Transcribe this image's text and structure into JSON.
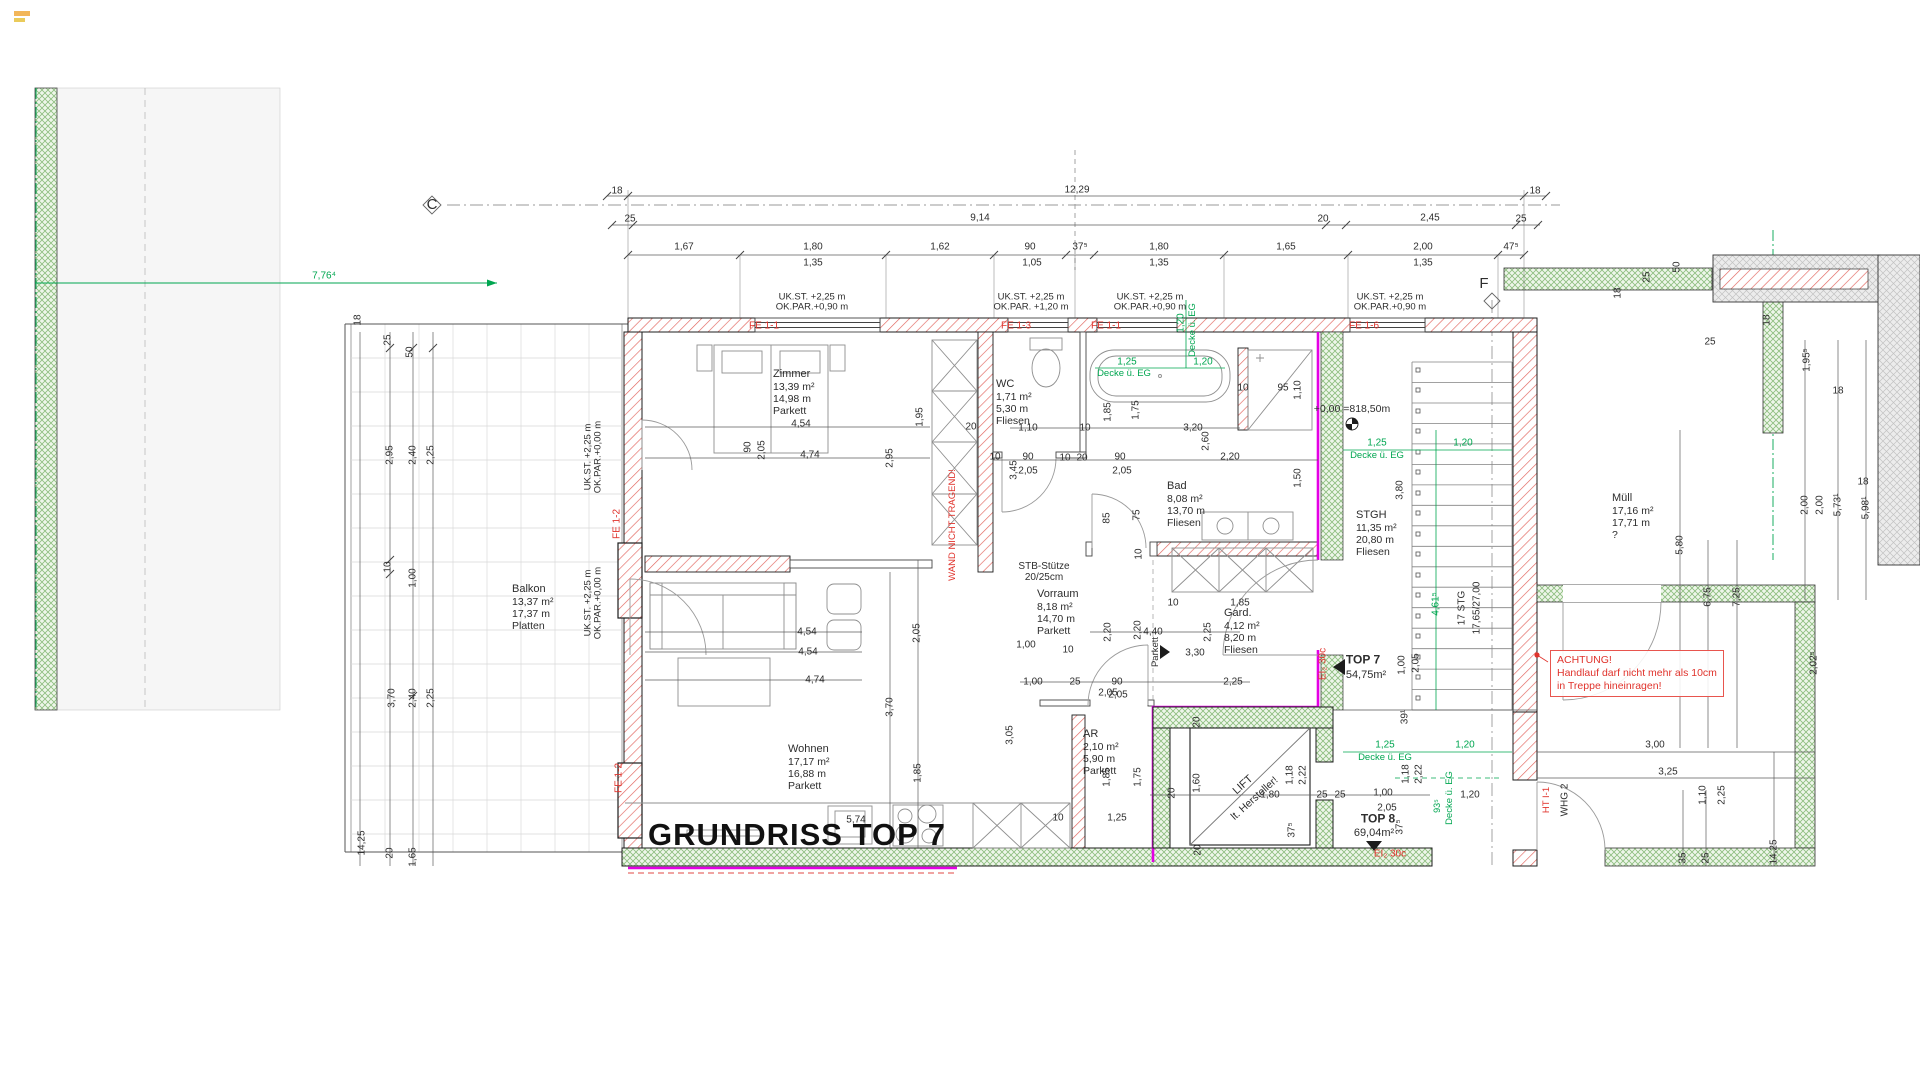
{
  "title": "GRUNDRISS TOP 7",
  "colors": {
    "red": "#e0332c",
    "green": "#00a650",
    "magenta": "#e400e4",
    "dim_text": "#2e2e2e",
    "wall": "#1c1c1c"
  },
  "notes": {
    "achtung": [
      "ACHTUNG!",
      "Handlauf darf nicht mehr als 10cm",
      "in Treppe hineinragen!"
    ]
  },
  "rooms": [
    {
      "name": "Zimmer",
      "area": "13,39 m²",
      "per": "14,98 m",
      "floor": "Parkett",
      "x": 773,
      "y": 368
    },
    {
      "name": "WC",
      "area": "1,71 m²",
      "per": "5,30 m",
      "floor": "Fliesen",
      "x": 996,
      "y": 378
    },
    {
      "name": "Bad",
      "area": "8,08 m²",
      "per": "13,70 m",
      "floor": "Fliesen",
      "x": 1167,
      "y": 480
    },
    {
      "name": "Vorraum",
      "area": "8,18 m²",
      "per": "14,70 m",
      "floor": "Parkett",
      "x": 1037,
      "y": 588
    },
    {
      "name": "Gard.",
      "area": "4,12 m²",
      "per": "8,20 m",
      "floor": "Fliesen",
      "x": 1224,
      "y": 607
    },
    {
      "name": "STGH",
      "area": "11,35 m²",
      "per": "20,80 m",
      "floor": "Fliesen",
      "x": 1356,
      "y": 509
    },
    {
      "name": "Wohnen",
      "area": "17,17 m²",
      "per": "16,88 m",
      "floor": "Parkett",
      "x": 788,
      "y": 743
    },
    {
      "name": "AR",
      "area": "2,10 m²",
      "per": "5,90 m",
      "floor": "Parkett",
      "x": 1083,
      "y": 728
    },
    {
      "name": "Balkon",
      "area": "13,37 m²",
      "per": "17,37 m",
      "floor": "Platten",
      "x": 512,
      "y": 583
    },
    {
      "name": "Müll",
      "area": "17,16 m²",
      "per": "17,71 m",
      "floor": "?",
      "x": 1612,
      "y": 492
    }
  ],
  "labels": [
    [
      "18",
      617,
      191
    ],
    [
      "12,29",
      1077,
      190
    ],
    [
      "18",
      1535,
      191
    ],
    [
      "25",
      630,
      219
    ],
    [
      "9,14",
      980,
      218
    ],
    [
      "20",
      1323,
      219
    ],
    [
      "2,45",
      1430,
      218
    ],
    [
      "25",
      1521,
      219
    ],
    [
      "1,67",
      684,
      247
    ],
    [
      "1,80",
      813,
      247
    ],
    [
      "1,62",
      940,
      247
    ],
    [
      "90",
      1030,
      247
    ],
    [
      "37⁵",
      1080,
      247
    ],
    [
      "1,80",
      1159,
      247
    ],
    [
      "1,65",
      1286,
      247
    ],
    [
      "2,00",
      1423,
      247
    ],
    [
      "47⁵",
      1511,
      247
    ],
    [
      "1,35",
      813,
      263
    ],
    [
      "1,05",
      1032,
      263
    ],
    [
      "1,35",
      1159,
      263
    ],
    [
      "1,35",
      1423,
      263
    ],
    [
      "UK.ST.   +2,25 m\nOK.PAR.+0,90 m",
      812,
      303,
      0,
      "k",
      9.5
    ],
    [
      "UK.ST.   +2,25 m\nOK.PAR. +1,20 m",
      1031,
      303,
      0,
      "k",
      9.5
    ],
    [
      "UK.ST.   +2,25 m\nOK.PAR.+0,90 m",
      1150,
      303,
      0,
      "k",
      9.5
    ],
    [
      "UK.ST.   +2,25 m\nOK.PAR.+0,90 m",
      1390,
      303,
      0,
      "k",
      9.5
    ],
    [
      "UK.ST.  +2,25 m\nOK.PAR.+0,00 m",
      594,
      457,
      -90,
      "k",
      9.5
    ],
    [
      "UK.ST.  +2,25 m\nOK.PAR.+0,00 m",
      594,
      603,
      -90,
      "k",
      9.5
    ],
    [
      "FE 1-1",
      764,
      326,
      0,
      "r"
    ],
    [
      "FE 1-3",
      1016,
      326,
      0,
      "r"
    ],
    [
      "FE 1-1",
      1106,
      326,
      0,
      "r"
    ],
    [
      "FE 1-6",
      1364,
      326,
      0,
      "r"
    ],
    [
      "FE 1-2",
      617,
      524,
      -90,
      "r"
    ],
    [
      "FE 1-2",
      619,
      778,
      -90,
      "r"
    ],
    [
      "WAND NICHT TRAGEND!",
      953,
      525,
      -90,
      "r",
      9.5
    ],
    [
      "EI₂ 30c",
      1323,
      664,
      -90,
      "r"
    ],
    [
      "EI₂ 30c",
      1390,
      854,
      0,
      "r"
    ],
    [
      "HT I-1",
      1547,
      800,
      -90,
      "r",
      9.5
    ],
    [
      "7,76⁴",
      324,
      276,
      0,
      "g"
    ],
    [
      "1,25",
      1127,
      362,
      0,
      "g"
    ],
    [
      "Decke ü. EG",
      1124,
      374,
      0,
      "g",
      9.5
    ],
    [
      "1,20",
      1181,
      323,
      -90,
      "g"
    ],
    [
      "Decke ü. EG",
      1193,
      330,
      -90,
      "g",
      9.5
    ],
    [
      "1,20",
      1203,
      362,
      0,
      "g"
    ],
    [
      "1,25",
      1377,
      443,
      0,
      "g"
    ],
    [
      "Decke ü. EG",
      1377,
      456,
      0,
      "g",
      9.5
    ],
    [
      "1,20",
      1463,
      443,
      0,
      "g"
    ],
    [
      "1,25",
      1385,
      745,
      0,
      "g"
    ],
    [
      "Decke ü. EG",
      1385,
      758,
      0,
      "g",
      9.5
    ],
    [
      "1,20",
      1465,
      745,
      0,
      "g"
    ],
    [
      "4,61⁵",
      1436,
      604,
      -90,
      "g"
    ],
    [
      "93⁵",
      1438,
      806,
      -90,
      "g",
      9
    ],
    [
      "Decke ü. EG",
      1450,
      798,
      -90,
      "g",
      9.5
    ],
    [
      "STB-Stütze\n20/25cm",
      1044,
      572,
      0,
      "k",
      10
    ],
    [
      "+0,00 =818,50m",
      1352,
      410,
      0,
      "k",
      10.5
    ],
    [
      "5,74",
      856,
      820,
      0,
      "k",
      10
    ],
    [
      "17 STG",
      1462,
      608,
      -90
    ],
    [
      "17,65/27,00",
      1477,
      608,
      -90
    ],
    [
      "TOP 7",
      1363,
      660,
      0,
      "k",
      12,
      "b"
    ],
    [
      "54,75m²",
      1366,
      675,
      0,
      "k",
      11
    ],
    [
      "TOP 8",
      1378,
      819,
      0,
      "k",
      12,
      "b"
    ],
    [
      "69,04m²",
      1374,
      833,
      0,
      "k",
      11
    ],
    [
      "WHG 2",
      1565,
      800,
      -90
    ],
    [
      "LIFT",
      1243,
      785,
      -42,
      "k",
      11
    ],
    [
      "lt. Hersteller!",
      1255,
      799,
      -42,
      "k",
      10.5
    ],
    [
      "Parkett",
      1156,
      652,
      -90,
      "k",
      9.5
    ],
    [
      "C",
      432,
      205,
      0,
      "k",
      15
    ],
    [
      "F",
      1484,
      284,
      0,
      "k",
      15
    ],
    [
      "1,20",
      1470,
      795
    ],
    [
      "4,54",
      801,
      424
    ],
    [
      "4,74",
      810,
      455
    ],
    [
      "1,95",
      920,
      417,
      -90
    ],
    [
      "2,95",
      890,
      458,
      -90
    ],
    [
      "20",
      971,
      427
    ],
    [
      "90",
      748,
      447,
      -90
    ],
    [
      "2,05",
      762,
      450,
      -90
    ],
    [
      "1,10",
      1028,
      428
    ],
    [
      "10",
      1085,
      428
    ],
    [
      "90",
      1028,
      457
    ],
    [
      "2,05",
      1028,
      471
    ],
    [
      "10",
      995,
      457
    ],
    [
      "3,45",
      1014,
      470,
      -90
    ],
    [
      "10",
      1065,
      458
    ],
    [
      "20",
      1082,
      458
    ],
    [
      "90",
      1120,
      457
    ],
    [
      "2,05",
      1122,
      471
    ],
    [
      "1,85",
      1108,
      412,
      -90
    ],
    [
      "1,75",
      1136,
      410,
      -90
    ],
    [
      "3,20",
      1193,
      428
    ],
    [
      "2,60",
      1206,
      441,
      -90
    ],
    [
      "2,20",
      1230,
      457
    ],
    [
      "10",
      1243,
      388
    ],
    [
      "95",
      1283,
      388
    ],
    [
      "1,10",
      1298,
      390,
      -90
    ],
    [
      "1,50",
      1298,
      478,
      -90
    ],
    [
      "85",
      1107,
      518,
      -90
    ],
    [
      "75",
      1137,
      515,
      -90
    ],
    [
      "10",
      1139,
      554,
      -90
    ],
    [
      "3,80",
      1400,
      490,
      -90
    ],
    [
      "10",
      1173,
      603
    ],
    [
      "1,85",
      1240,
      603
    ],
    [
      "2,20",
      1108,
      632,
      -90
    ],
    [
      "2,20",
      1138,
      630,
      -90
    ],
    [
      "4,40",
      1153,
      632
    ],
    [
      "2,25",
      1208,
      632,
      -90
    ],
    [
      "3,30",
      1195,
      653
    ],
    [
      "1,00",
      1026,
      645
    ],
    [
      "10",
      1068,
      650
    ],
    [
      "1,00",
      1033,
      682
    ],
    [
      "25",
      1075,
      682
    ],
    [
      "90",
      1117,
      682
    ],
    [
      "2,05",
      1118,
      695
    ],
    [
      "2,25",
      1233,
      682
    ],
    [
      "4,54",
      807,
      632
    ],
    [
      "4,54",
      808,
      652
    ],
    [
      "4,74",
      815,
      680
    ],
    [
      "2,05",
      917,
      633,
      -90
    ],
    [
      "3,70",
      890,
      707,
      -90
    ],
    [
      "1,85",
      918,
      773,
      -90
    ],
    [
      "3,05",
      1010,
      735,
      -90
    ],
    [
      "10",
      1058,
      818
    ],
    [
      "1,25",
      1117,
      818
    ],
    [
      "1,85",
      1107,
      777,
      -90
    ],
    [
      "1,75",
      1138,
      777,
      -90
    ],
    [
      "20",
      1172,
      793,
      -90
    ],
    [
      "1,60",
      1197,
      783,
      -90
    ],
    [
      "1,80",
      1270,
      795
    ],
    [
      "1,18",
      1290,
      775,
      -90
    ],
    [
      "2,22",
      1303,
      775,
      -90
    ],
    [
      "25",
      1322,
      795
    ],
    [
      "25",
      1340,
      795
    ],
    [
      "1,00",
      1383,
      793
    ],
    [
      "2,05",
      1387,
      808
    ],
    [
      "37⁵",
      1292,
      830,
      -90
    ],
    [
      "37⁵",
      1400,
      827,
      -90
    ],
    [
      "39¹",
      1405,
      717,
      -90
    ],
    [
      "1,00",
      1402,
      665,
      -90
    ],
    [
      "2,05",
      1416,
      663,
      -90
    ],
    [
      "1,18",
      1406,
      774,
      -90
    ],
    [
      "2,22",
      1419,
      774,
      -90
    ],
    [
      "20",
      1198,
      850,
      -90
    ],
    [
      "20",
      1197,
      722,
      -90
    ],
    [
      "2,05",
      1108,
      693
    ],
    [
      "18",
      358,
      320,
      -90
    ],
    [
      "25",
      388,
      340,
      -90
    ],
    [
      "50",
      410,
      352,
      -90
    ],
    [
      "2,95",
      390,
      455,
      -90
    ],
    [
      "2,40",
      413,
      455,
      -90
    ],
    [
      "2,25",
      431,
      455,
      -90
    ],
    [
      "10",
      388,
      567,
      -90
    ],
    [
      "1,00",
      413,
      578,
      -90
    ],
    [
      "3,70",
      392,
      698,
      -90
    ],
    [
      "2,40",
      413,
      698,
      -90
    ],
    [
      "2,25",
      431,
      698,
      -90
    ],
    [
      "14,25",
      362,
      843,
      -90
    ],
    [
      "20",
      390,
      853,
      -90
    ],
    [
      "1,65",
      413,
      857,
      -90
    ],
    [
      "5,80",
      1680,
      545,
      -90
    ],
    [
      "6,75",
      1708,
      597,
      -90
    ],
    [
      "7,25",
      1737,
      597,
      -90
    ],
    [
      "18",
      1618,
      293,
      -90
    ],
    [
      "25",
      1647,
      277,
      -90
    ],
    [
      "50",
      1677,
      267,
      -90
    ],
    [
      "25",
      1710,
      342
    ],
    [
      "18",
      1767,
      320,
      -90
    ],
    [
      "1,95⁵",
      1807,
      360,
      -90
    ],
    [
      "2,00",
      1805,
      505,
      -90
    ],
    [
      "2,00",
      1820,
      505,
      -90
    ],
    [
      "5,73¹",
      1838,
      505,
      -90
    ],
    [
      "5,98¹",
      1866,
      508,
      -90
    ],
    [
      "18",
      1863,
      482
    ],
    [
      "18",
      1838,
      391
    ],
    [
      "2,02⁵",
      1814,
      663,
      -90
    ],
    [
      "3,00",
      1655,
      745
    ],
    [
      "3,25",
      1668,
      772
    ],
    [
      "1,10",
      1703,
      795,
      -90
    ],
    [
      "2,25",
      1722,
      795,
      -90
    ],
    [
      "35",
      1683,
      858,
      -90
    ],
    [
      "25",
      1706,
      858,
      -90
    ],
    [
      "14,25",
      1774,
      852,
      -90
    ]
  ]
}
